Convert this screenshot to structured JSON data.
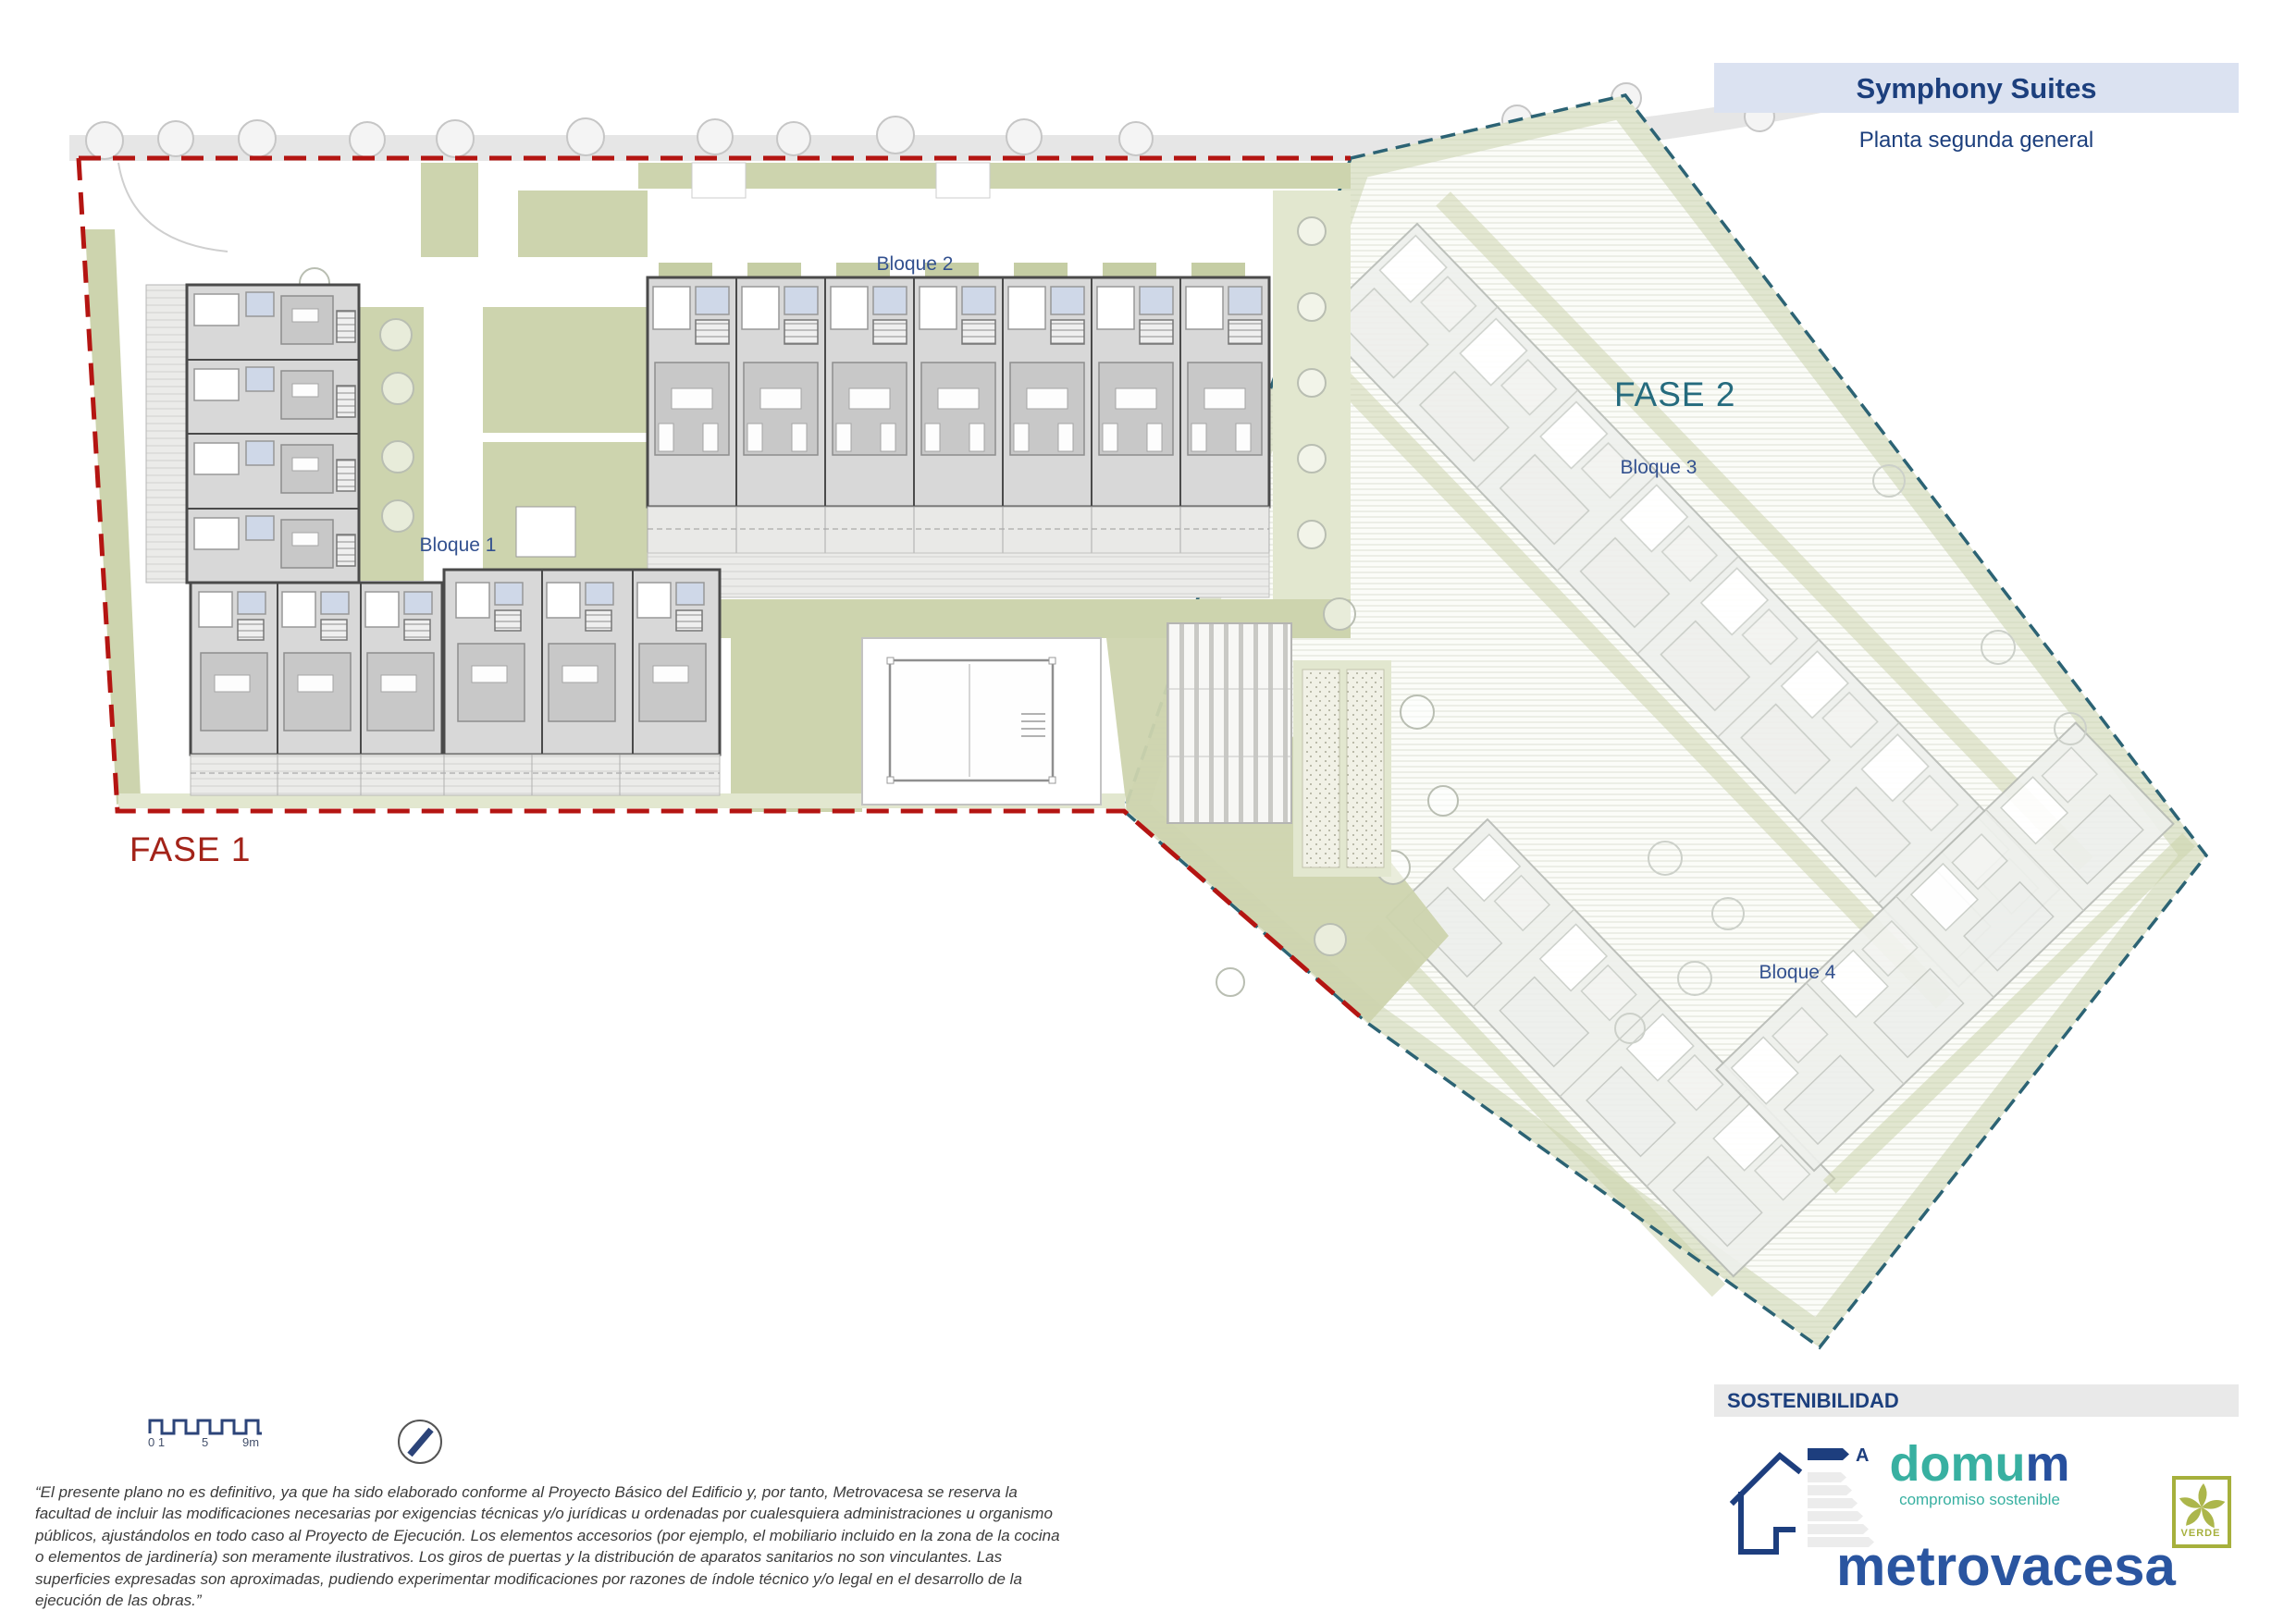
{
  "title_block": {
    "project": "Symphony Suites",
    "subtitle": "Planta segunda general"
  },
  "phases": {
    "fase1": {
      "label": "FASE 1",
      "color": "#a32319",
      "boundary_color": "#b41512"
    },
    "fase2": {
      "label": "FASE 2",
      "color": "#256b7e",
      "boundary_color": "#2c6374"
    }
  },
  "blocks": {
    "bloque1": "Bloque 1",
    "bloque2": "Bloque 2",
    "bloque3": "Bloque 3",
    "bloque4": "Bloque 4"
  },
  "scale_bar": {
    "tick_start": "0 1",
    "tick_mid": "5",
    "tick_end": "9m"
  },
  "north_arrow": "north-arrow",
  "disclaimer": "“El presente plano no es definitivo, ya que ha sido elaborado conforme al Proyecto Básico del Edificio y, por tanto, Metrovacesa se reserva la facultad de incluir las modificaciones necesarias por exigencias técnicas y/o jurídicas u ordenadas por cualesquiera administraciones u organismo públicos, ajustándolos en todo caso al Proyecto de Ejecución. Los elementos accesorios (por ejemplo, el mobiliario incluido en la zona de la cocina o elementos de jardinería) son meramente ilustrativos. Los giros de puertas y la distribución de aparatos sanitarios no son vinculantes. Las superficies expresadas son aproximadas, pudiendo experimentar modificaciones por razones de índole técnico y/o legal en el desarrollo de la ejecución de las obras.”",
  "sustainability": {
    "header": "SOSTENIBILIDAD",
    "energy_rating_letter": "A",
    "domum": {
      "name_primary": "domu",
      "name_accent": "m",
      "tagline": "compromiso sostenible"
    },
    "metrovacesa": "metrovacesa",
    "verde_badge": "VERDE"
  },
  "colors": {
    "title_bar_bg": "#dbe2f1",
    "navy": "#1c3f7d",
    "block_label_blue": "#33518f",
    "sage_green": "#cdd4ae",
    "road_gray": "#e6e6e6",
    "domum_teal": "#38b0a1",
    "metrovacesa_blue": "#2a55a0",
    "verde_olive": "#a6b03c"
  }
}
